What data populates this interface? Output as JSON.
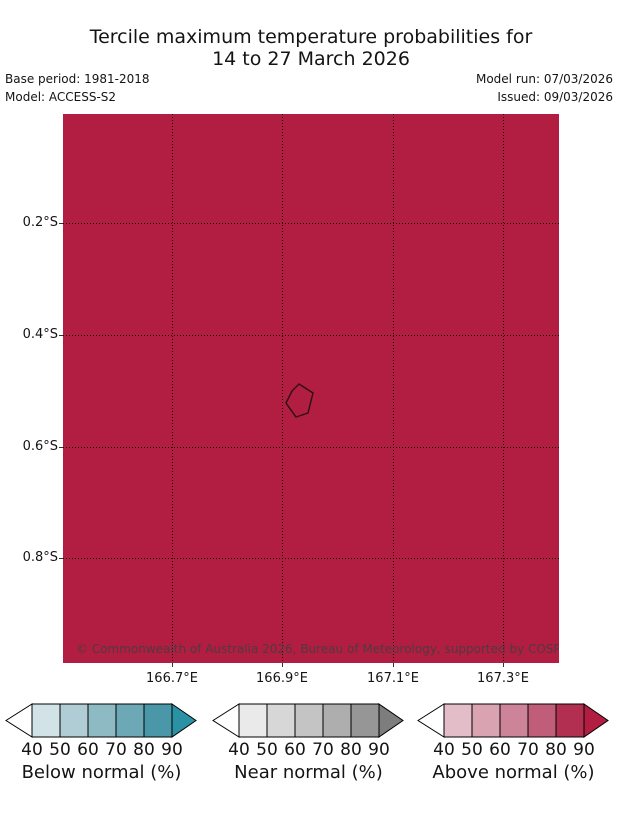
{
  "title": {
    "line1": "Tercile maximum temperature probabilities for",
    "line2": "14 to 27 March 2026"
  },
  "meta": {
    "base_period": "Base period: 1981-2018",
    "model": "Model: ACCESS-S2",
    "model_run": "Model run: 07/03/2026",
    "issued": "Issued: 09/03/2026"
  },
  "map": {
    "fill_color": "#b11e41",
    "copyright": "© Commonwealth of Australia 2026, Bureau of Meteorology, supported by COSPPac",
    "x_ticks": [
      "166.7°E",
      "166.9°E",
      "167.1°E",
      "167.3°E"
    ],
    "y_ticks": [
      "0.2°S",
      "0.4°S",
      "0.6°S",
      "0.8°S"
    ]
  },
  "legend": {
    "tick_values": [
      "40",
      "50",
      "60",
      "70",
      "80",
      "90"
    ],
    "bars": [
      {
        "label": "Below normal (%)",
        "colors": [
          "#d2e3e8",
          "#b0cdd5",
          "#8ebac4",
          "#6da8b6",
          "#4997a8"
        ],
        "arrow_color": "#2b92a5"
      },
      {
        "label": "Near normal (%)",
        "colors": [
          "#eaeaea",
          "#d7d7d7",
          "#c4c4c4",
          "#aeaeae",
          "#969696"
        ],
        "arrow_color": "#7d7d7d"
      },
      {
        "label": "Above normal (%)",
        "colors": [
          "#e3bdc7",
          "#d9a3b1",
          "#cd8398",
          "#c05e79",
          "#b32f52"
        ],
        "arrow_color": "#b11e41"
      }
    ]
  },
  "chart_data": {
    "type": "map",
    "region_fill": "uniform",
    "fill_meaning": "Above normal probability > 90%",
    "lon_ticks": [
      166.7,
      166.9,
      167.1,
      167.3
    ],
    "lat_ticks": [
      -0.2,
      -0.4,
      -0.6,
      -0.8
    ],
    "legend_scales": [
      "Below normal (%)",
      "Near normal (%)",
      "Above normal (%)"
    ],
    "legend_scale_range": [
      40,
      90
    ]
  }
}
